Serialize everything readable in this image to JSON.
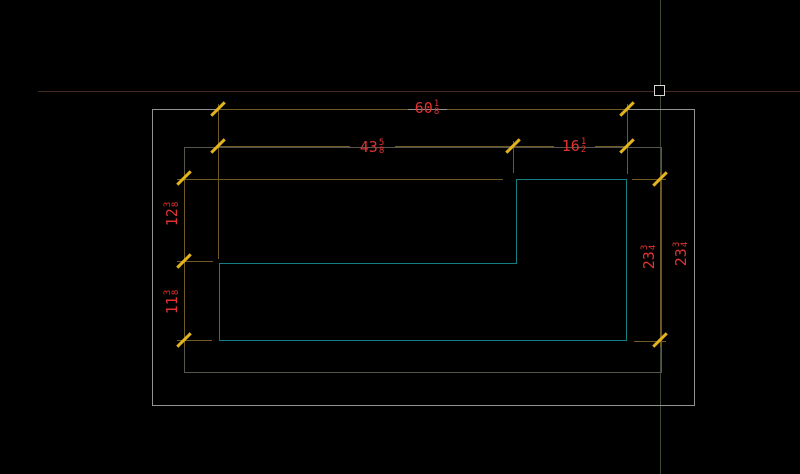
{
  "canvas": {
    "description_background": "#000000",
    "cursor": {
      "pickbox_color": "#d9d9d9",
      "crosshair_horizontal_color": "#452a22",
      "crosshair_vertical_color": "#3e4a38"
    },
    "colors": {
      "part_outline": "#128080",
      "dimension_lines": "#6e5a22",
      "dimension_ticks": "#e3b41e",
      "dimension_text": "#e13232",
      "outer_frame": "#929292",
      "inner_frame": "#56564f"
    }
  },
  "dimensions": {
    "width_total": {
      "whole": "60",
      "numerator": "1",
      "denominator": "8"
    },
    "width_left": {
      "whole": "43",
      "numerator": "5",
      "denominator": "8"
    },
    "width_right": {
      "whole": "16",
      "numerator": "1",
      "denominator": "2"
    },
    "height_upper_left": {
      "whole": "12",
      "numerator": "3",
      "denominator": "8"
    },
    "height_lower_left": {
      "whole": "11",
      "numerator": "3",
      "denominator": "8"
    },
    "height_right": {
      "whole": "23",
      "numerator": "3",
      "denominator": "4"
    },
    "height_right_dup": {
      "whole": "23",
      "numerator": "3",
      "denominator": "4"
    }
  }
}
